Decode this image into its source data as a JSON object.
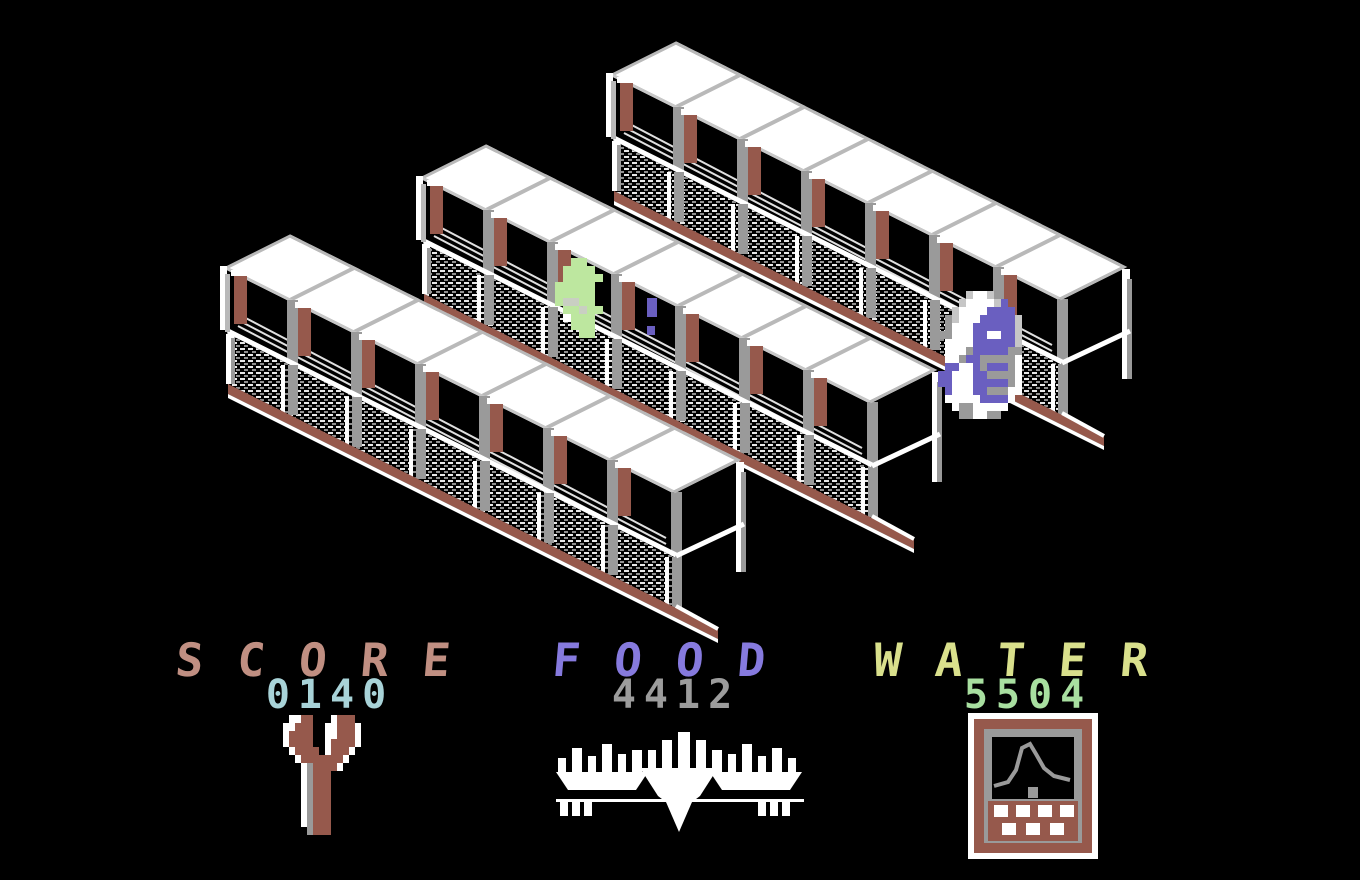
{
  "meta": {
    "title": "isometric-greenhouse-game-screen",
    "width": 1360,
    "height": 880,
    "background": "#000000"
  },
  "palette": {
    "white": "#ffffff",
    "light_gray": "#b9b9b9",
    "gray": "#9a9a9a",
    "brown": "#96594c",
    "salmon": "#c08f82",
    "cyan": "#a8d3d8",
    "purple_label": "#867ade",
    "value_gray": "#9c9c9c",
    "yellow": "#d9e08c",
    "light_green": "#a8dfa0",
    "plant_green": "#bde79f",
    "robot_purple": "#6a5fc0"
  },
  "hud": {
    "score": {
      "label": "SCORE",
      "value": "0140",
      "label_color": "#c08f82",
      "value_color": "#a8d3d8",
      "center_x": 330,
      "label_top": 637,
      "value_top": 675,
      "icon": "wrench-icon"
    },
    "food": {
      "label": "FOOD",
      "value": "4412",
      "label_color": "#867ade",
      "value_color": "#9c9c9c",
      "center_x": 676,
      "label_top": 637,
      "value_top": 675,
      "icon": "crop-plant-icon"
    },
    "water": {
      "label": "WATER",
      "value": "5504",
      "label_color": "#d9e08c",
      "value_color": "#a8dfa0",
      "center_x": 1028,
      "label_top": 637,
      "value_top": 675,
      "icon": "water-meter-icon"
    }
  },
  "scene": {
    "bays": 7,
    "structures": [
      {
        "name": "greenhouse-truss-back",
        "origin": [
          676,
          43
        ]
      },
      {
        "name": "greenhouse-truss-middle",
        "origin": [
          486,
          146
        ]
      },
      {
        "name": "greenhouse-truss-front",
        "origin": [
          290,
          236
        ]
      }
    ],
    "colors": {
      "roof": "#ffffff",
      "trim": "#b9b9b9",
      "edge": "#c8c8c8",
      "post": "#9a9a9a",
      "pillar": "#96594c",
      "slat": "#e0e0e0",
      "rail": "#96594c"
    },
    "sprite_colors": {
      "W": "#ffffff",
      "L": "#c6c6c6",
      "G": "#9a9a9a",
      "P": "#6a5fc0",
      "B": "#96594c",
      "F": "#bde79f",
      "H": "#c9cfc2"
    },
    "sprites": {
      "robot": {
        "name": "robot-droid-sprite",
        "pos": [
          938,
          291
        ],
        "cell": [
          7,
          8
        ],
        "map": [
          "....LWWL......",
          "...LWWWWLP....",
          "..LWWWWPPPP...",
          ".GLWWWPPPPPL..",
          ".GWWWPPPPPPL..",
          "GGWWWPPWWPPL..",
          ".WWWWPPPPPPL..",
          ".WWWGPPPPPGG..",
          ".WWGPPGGGGGW..",
          ".PPWWPGPPPGW..",
          "PPWWWPPGGGGW..",
          "PPWWWPPPPPGW..",
          ".PWWWPPGGGWW..",
          ".WWWWWPPPPW...",
          "..WGGWWWWW....",
          "...GGWWGG....."
        ]
      },
      "plant": {
        "name": "green-plant-sprite",
        "pos": [
          555,
          258
        ],
        "cell": [
          8,
          8
        ],
        "map": [
          "..FF....",
          ".FFFF...",
          ".FFFFF..",
          "FFFFF...",
          "FFFFF...",
          "FHHFF...",
          ".FFHFF..",
          ".WFFF...",
          "..FFF...",
          "...FF..."
        ]
      },
      "creature": {
        "name": "small-creature-sprite",
        "color": "#6a5fc0",
        "rects": [
          [
            647,
            298,
            10,
            19
          ],
          [
            647,
            326,
            8,
            9
          ]
        ]
      }
    }
  },
  "icons": {
    "wrench": {
      "pos": [
        283,
        715
      ],
      "cell": [
        6,
        8
      ],
      "map": [
        ".WWBB...WBBB.",
        "WWBBB..WWBBBW",
        "WBBBB..WWBBBW",
        "WBBBB..WBBBBW",
        ".WBBBB.WBBBW.",
        "..WBBBBBBBW..",
        "...WGBBBBW...",
        "...WGBBB.....",
        "...WGBBB.....",
        "...WGBBB.....",
        "...WGBBB.....",
        "...WGBBB.....",
        "...WGBBB.....",
        "...WGBBB.....",
        "....GBBB....."
      ]
    }
  }
}
